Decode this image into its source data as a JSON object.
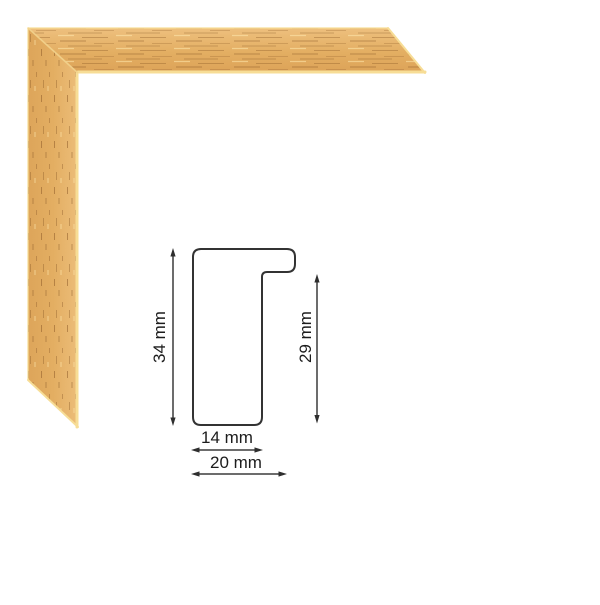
{
  "page": {
    "background_color": "#ffffff"
  },
  "frame_sample": {
    "wood_base_color": "#e3ae62",
    "wood_light_color": "#eec07e",
    "wood_dark_color": "#dda358",
    "grain_color": "#875626",
    "edge_highlight_color": "#f7dd96",
    "miter_seam_color": "#f2d28c"
  },
  "diagram": {
    "line_color": "#333333",
    "labels": {
      "total_height": "34 mm",
      "rabbet_height": "29 mm",
      "body_width": "14 mm",
      "total_width": "20 mm"
    }
  }
}
